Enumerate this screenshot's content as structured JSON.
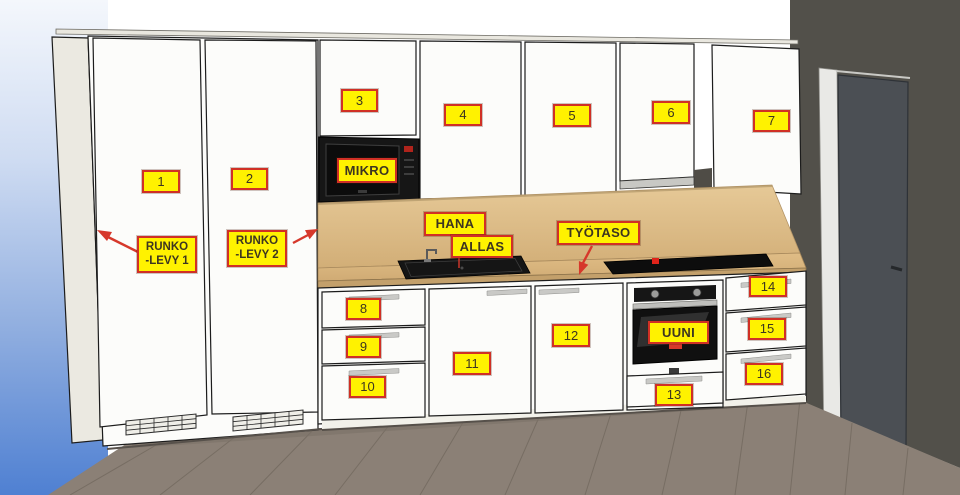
{
  "callouts": {
    "numbers": [
      "1",
      "2",
      "3",
      "4",
      "5",
      "6",
      "7",
      "8",
      "9",
      "10",
      "11",
      "12",
      "13",
      "14",
      "15",
      "16"
    ],
    "appliances": {
      "mikro": "MIKRO",
      "hana": "HANA",
      "allas": "ALLAS",
      "tyotaso": "TYÖTASO",
      "uuni": "UUNI"
    },
    "panels": {
      "runko_levy_1": "RUNKO\n-LEVY 1",
      "runko_levy_2": "RUNKO\n-LEVY 2"
    }
  },
  "colors": {
    "label_bg": "#fff200",
    "label_border": "#d03025",
    "label_text": "#3d3520",
    "arrow_red": "#d6382b",
    "cabinet_white": "#fcfcfa",
    "worktop_wood": "#dcb984",
    "backsplash_wood": "#e2c593",
    "wall_dark": "#52504a",
    "room_door_dark": "#4b4f54",
    "floor_gray": "#8b8076",
    "bg_blue": "#4f80d2",
    "appliance_black": "#141414"
  }
}
